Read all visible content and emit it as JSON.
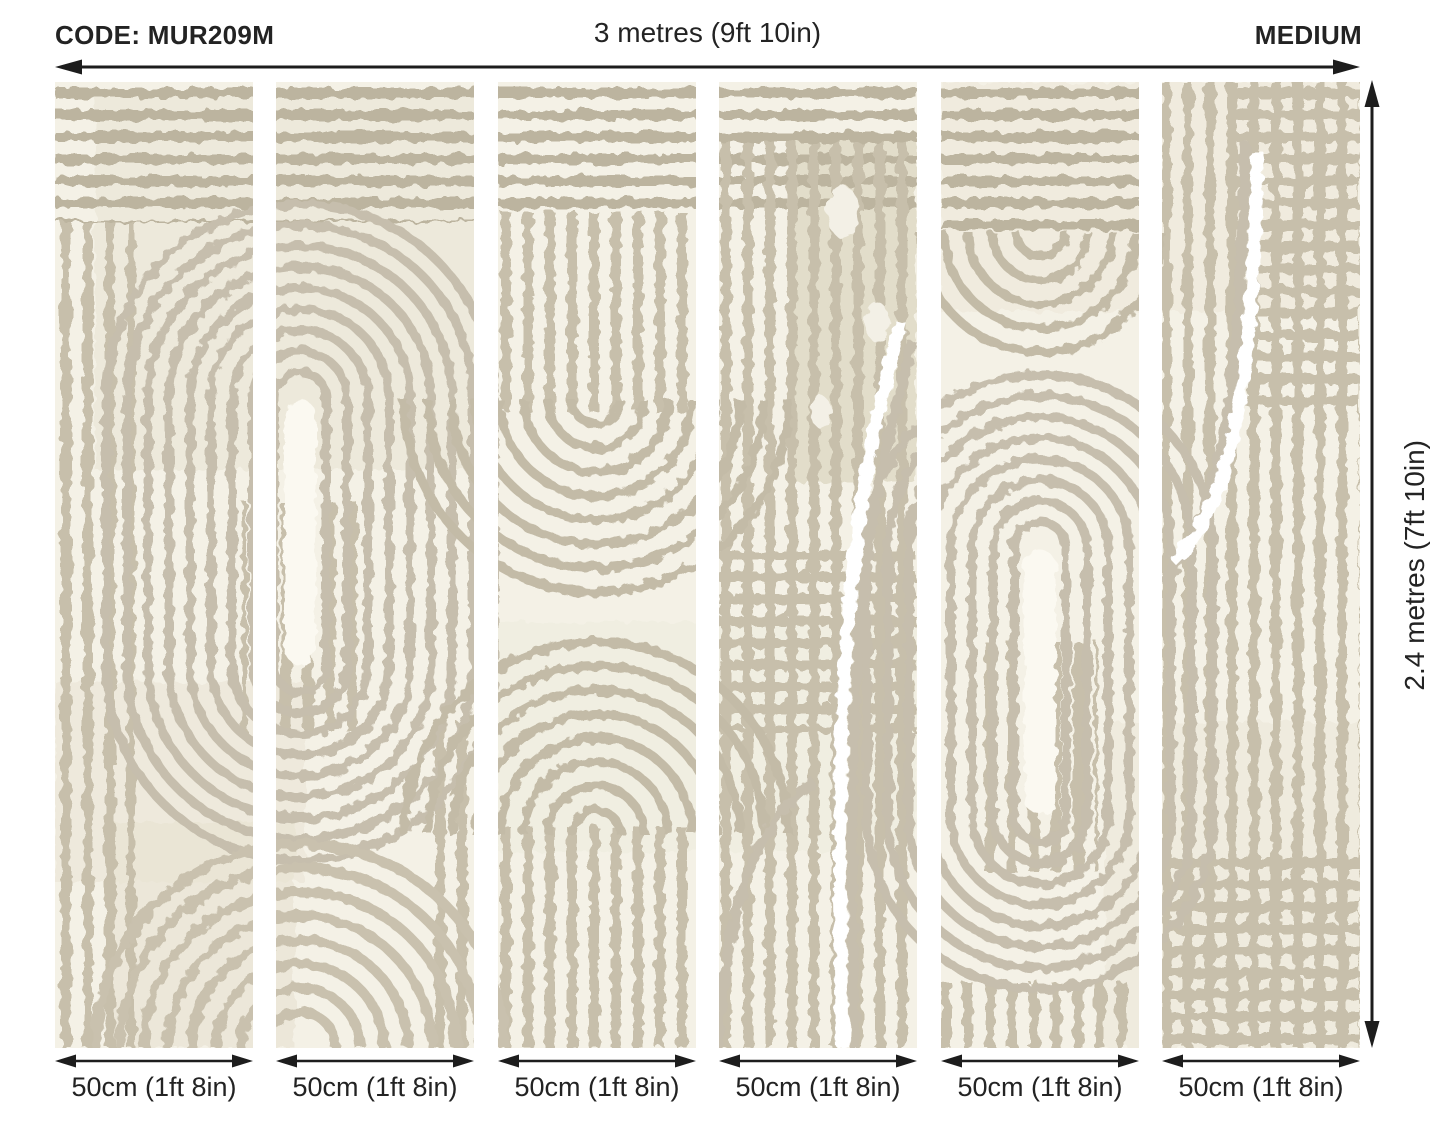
{
  "header": {
    "code_label": "CODE: MUR209M",
    "total_width_label": "3 metres (9ft 10in)",
    "size_label": "MEDIUM"
  },
  "dimensions": {
    "total_width": "3 metres (9ft 10in)",
    "total_height": "2.4 metres (7ft 10in)",
    "panel_width": "50cm (1ft 8in)",
    "panel_count": 6
  },
  "height_label": "2.4 metres (7ft 10in)",
  "panels": [
    {
      "label": "50cm (1ft 8in)"
    },
    {
      "label": "50cm (1ft 8in)"
    },
    {
      "label": "50cm (1ft 8in)"
    },
    {
      "label": "50cm (1ft 8in)"
    },
    {
      "label": "50cm (1ft 8in)"
    },
    {
      "label": "50cm (1ft 8in)"
    }
  ],
  "mural": {
    "description": "abstract arch and stripe wallpaper pattern",
    "colors": {
      "background": "#f4f1e6",
      "stripe": "#c7bfab",
      "stripe_dark": "#bcb49f",
      "patch": "#e7e2d1",
      "patch_dark": "#e2ddca",
      "highlight": "#fbf9f1",
      "white": "#ffffff",
      "ink": "#1d1d1d"
    }
  }
}
